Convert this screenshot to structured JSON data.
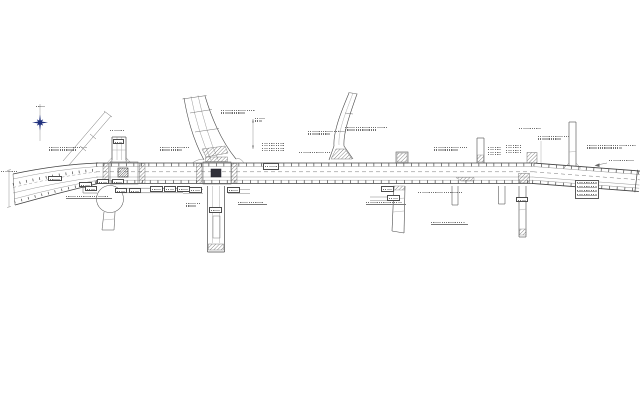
{
  "meta": {
    "description": "road improvement plan drawing, CAD line work on white, all annotation text sub-3px illegible"
  },
  "colors": {
    "background": "#ffffff",
    "edge_line": "#3f3f3f",
    "light_line": "#8f8f8f",
    "tick": "#4a4a4a",
    "hatch": "#555555",
    "annotation": "#6e6e6e",
    "north_star": "#1e2f7d",
    "dark_block": "#30303a"
  },
  "north_arrow": {
    "icon": "north-star-icon",
    "x": 40,
    "y": 122.5
  },
  "annotations": [
    {
      "x": 49,
      "y": 147,
      "w": 38,
      "lines": 2
    },
    {
      "x": 1,
      "y": 171,
      "w": 17,
      "lines": 1
    },
    {
      "x": 66,
      "y": 196,
      "w": 42,
      "lines": 1,
      "underline": true
    },
    {
      "x": 160,
      "y": 147,
      "w": 30,
      "lines": 2
    },
    {
      "x": 221,
      "y": 110,
      "w": 34,
      "lines": 2
    },
    {
      "x": 238,
      "y": 202,
      "w": 26,
      "lines": 1,
      "underline": true
    },
    {
      "x": 299,
      "y": 152,
      "w": 32,
      "lines": 1
    },
    {
      "x": 308,
      "y": 131,
      "w": 31,
      "lines": 2
    },
    {
      "x": 345,
      "y": 127,
      "w": 43,
      "lines": 2
    },
    {
      "x": 434,
      "y": 147,
      "w": 33,
      "lines": 2
    },
    {
      "x": 418,
      "y": 192,
      "w": 44,
      "lines": 1
    },
    {
      "x": 366,
      "y": 202,
      "w": 36,
      "lines": 1,
      "underline": true
    },
    {
      "x": 431,
      "y": 222,
      "w": 34,
      "lines": 1,
      "underline": true
    },
    {
      "x": 538,
      "y": 136,
      "w": 32,
      "lines": 2
    },
    {
      "x": 519,
      "y": 128,
      "w": 22,
      "lines": 1
    },
    {
      "x": 587,
      "y": 145,
      "w": 49,
      "lines": 2
    },
    {
      "x": 609,
      "y": 160,
      "w": 25,
      "lines": 1
    },
    {
      "x": 110,
      "y": 130,
      "w": 14,
      "lines": 1
    },
    {
      "x": 36,
      "y": 106,
      "w": 9,
      "lines": 1
    },
    {
      "x": 186,
      "y": 203,
      "w": 14,
      "lines": 2
    },
    {
      "x": 255,
      "y": 118,
      "w": 10,
      "lines": 2
    }
  ],
  "boxed_labels": [
    {
      "x": 48,
      "y": 176,
      "w": 14,
      "h": 5
    },
    {
      "x": 79,
      "y": 182,
      "w": 13,
      "h": 5
    },
    {
      "x": 85,
      "y": 186,
      "w": 12,
      "h": 5
    },
    {
      "x": 97,
      "y": 179,
      "w": 12,
      "h": 5
    },
    {
      "x": 112,
      "y": 179,
      "w": 12,
      "h": 5
    },
    {
      "x": 115,
      "y": 188,
      "w": 12,
      "h": 5
    },
    {
      "x": 129,
      "y": 188,
      "w": 12,
      "h": 5
    },
    {
      "x": 113,
      "y": 139,
      "w": 11,
      "h": 5
    },
    {
      "x": 150,
      "y": 186,
      "w": 12.5,
      "h": 5.5
    },
    {
      "x": 163.5,
      "y": 186,
      "w": 12.5,
      "h": 5.5
    },
    {
      "x": 177,
      "y": 186,
      "w": 12.5,
      "h": 5.5
    },
    {
      "x": 189,
      "y": 187,
      "w": 13,
      "h": 6
    },
    {
      "x": 227,
      "y": 187,
      "w": 13,
      "h": 6
    },
    {
      "x": 209,
      "y": 207,
      "w": 13,
      "h": 6
    },
    {
      "x": 263,
      "y": 163,
      "w": 16,
      "h": 7
    },
    {
      "x": 381,
      "y": 186,
      "w": 13,
      "h": 6
    },
    {
      "x": 387,
      "y": 195,
      "w": 13,
      "h": 6
    },
    {
      "x": 516,
      "y": 197,
      "w": 12,
      "h": 5
    }
  ],
  "mini_tables": [
    {
      "x": 262,
      "y": 143,
      "w": 22,
      "rows": 4,
      "bordered": false
    },
    {
      "x": 488,
      "y": 147,
      "w": 13,
      "rows": 4,
      "bordered": false
    },
    {
      "x": 506,
      "y": 145,
      "w": 15,
      "rows": 4,
      "bordered": false
    },
    {
      "x": 575,
      "y": 180,
      "w": 24,
      "rows": 4,
      "bordered": true
    }
  ]
}
